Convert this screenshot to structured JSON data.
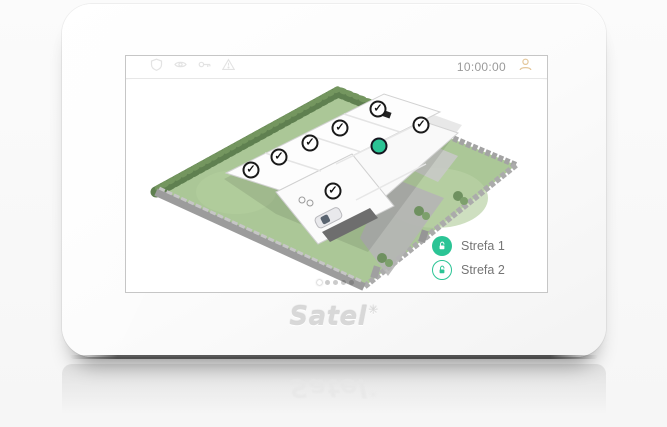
{
  "status_bar": {
    "time": "10:00:00",
    "indicator_icons": [
      "shield-icon",
      "bypass-eye-icon",
      "key-icon",
      "trouble-warning-icon"
    ]
  },
  "branding": {
    "logo_text": "Satel",
    "logo_mark": "✳"
  },
  "partitions": [
    {
      "label": "Strefa 1",
      "icon": "unlocked-padlock-filled",
      "state": "disarmed"
    },
    {
      "label": "Strefa 2",
      "icon": "unlocked-padlock-outline",
      "state": "disarmed"
    }
  ],
  "floor_map": {
    "sensors": [
      {
        "type": "check",
        "x": 252,
        "y": 29
      },
      {
        "type": "check",
        "x": 295,
        "y": 45
      },
      {
        "type": "check",
        "x": 214,
        "y": 48
      },
      {
        "type": "check",
        "x": 184,
        "y": 63
      },
      {
        "type": "check",
        "x": 153,
        "y": 77
      },
      {
        "type": "check",
        "x": 125,
        "y": 90
      },
      {
        "type": "check",
        "x": 207,
        "y": 111
      },
      {
        "type": "active-dot",
        "x": 253,
        "y": 66
      }
    ],
    "check_glyph": "✓"
  },
  "pagination": {
    "dots": 5,
    "active_index": 0
  },
  "colors": {
    "accent": "#2bc495",
    "badge_border": "#1a1a1a",
    "time_text": "#9a9a9a"
  }
}
